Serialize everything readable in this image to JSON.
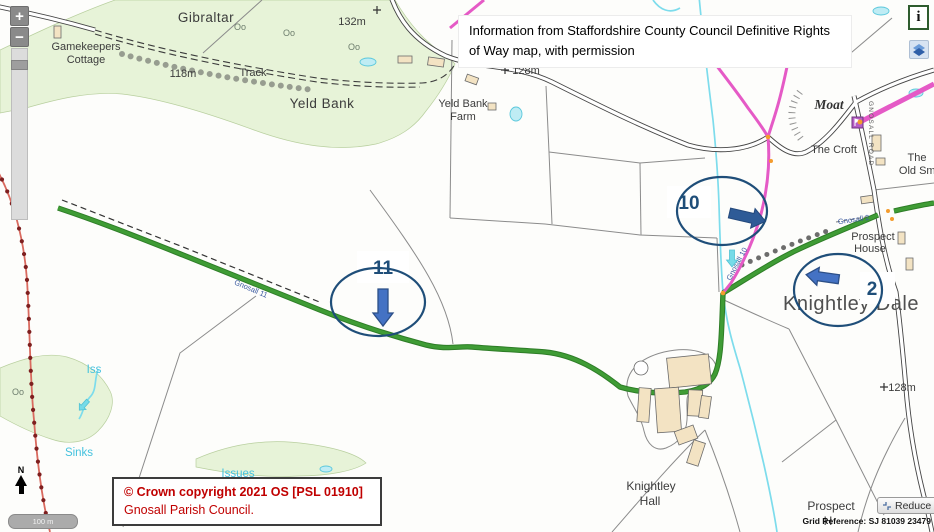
{
  "notice": {
    "line1": "Information from Staffordshire County Council Definitive Rights",
    "line2": "of Way map, with permission"
  },
  "controls": {
    "zoom_in": "+",
    "zoom_out": "−",
    "info": "i",
    "reduce": "Reduce",
    "scale": "100 m",
    "north": "N"
  },
  "footer": {
    "copyright_line1": "© Crown copyright 2021 OS [PSL 01910]",
    "copyright_line2": "Gnosall Parish Council.",
    "grid_reference": "Grid Reference: SJ 81039 23479"
  },
  "annotations": {
    "n10": "10",
    "n11": "11",
    "n2": "2"
  },
  "labels": {
    "gibraltar": "Gibraltar",
    "gamekeepers1": "Gamekeepers",
    "gamekeepers2": "Cottage",
    "h118": "118m",
    "track": "Track",
    "h132": "132m",
    "yeld_bank": "Yeld Bank",
    "farm1": "Yeld Bank",
    "farm2": "Farm",
    "h128a": "128m",
    "h128b": "128m",
    "moat": "Moat",
    "croft": "The Croft",
    "gnosall_road": "GNOSALL ROAD",
    "smithy1": "The",
    "smithy2": "Old Smit",
    "prospect1": "Prospect",
    "prospect2": "House",
    "knightley_dale": "Knightley Dale",
    "hall1": "Knightley",
    "hall2": "Hall",
    "prospect_b1": "Prospect",
    "prospect_b2": "H",
    "iss": "Iss",
    "sinks": "Sinks",
    "issues": "Issues",
    "path10": "Gnosall 10",
    "path11": "Gnosall 11",
    "path2": "Gnosall 2",
    "tree": "Oo"
  },
  "colors": {
    "navy": "#1f4e79",
    "arrow_blue": "#4472c4",
    "arrow_dark_blue": "#2e5b97",
    "route_green": "#3f9c35",
    "route_green_dark": "#2e7d27",
    "route_pink": "#e55ac6",
    "stream": "#7ddcec",
    "water_label": "#45c2de",
    "red_text": "#c00000",
    "boundary_red": "#d96a5f",
    "boundary_dot": "#7e1f1f",
    "building": "#f3e3c3",
    "green_area": "#e7f3d8",
    "orange_dot": "#f49c2d",
    "info_border": "#2e5c2e",
    "path_label_blue": "#3b5aa0"
  }
}
